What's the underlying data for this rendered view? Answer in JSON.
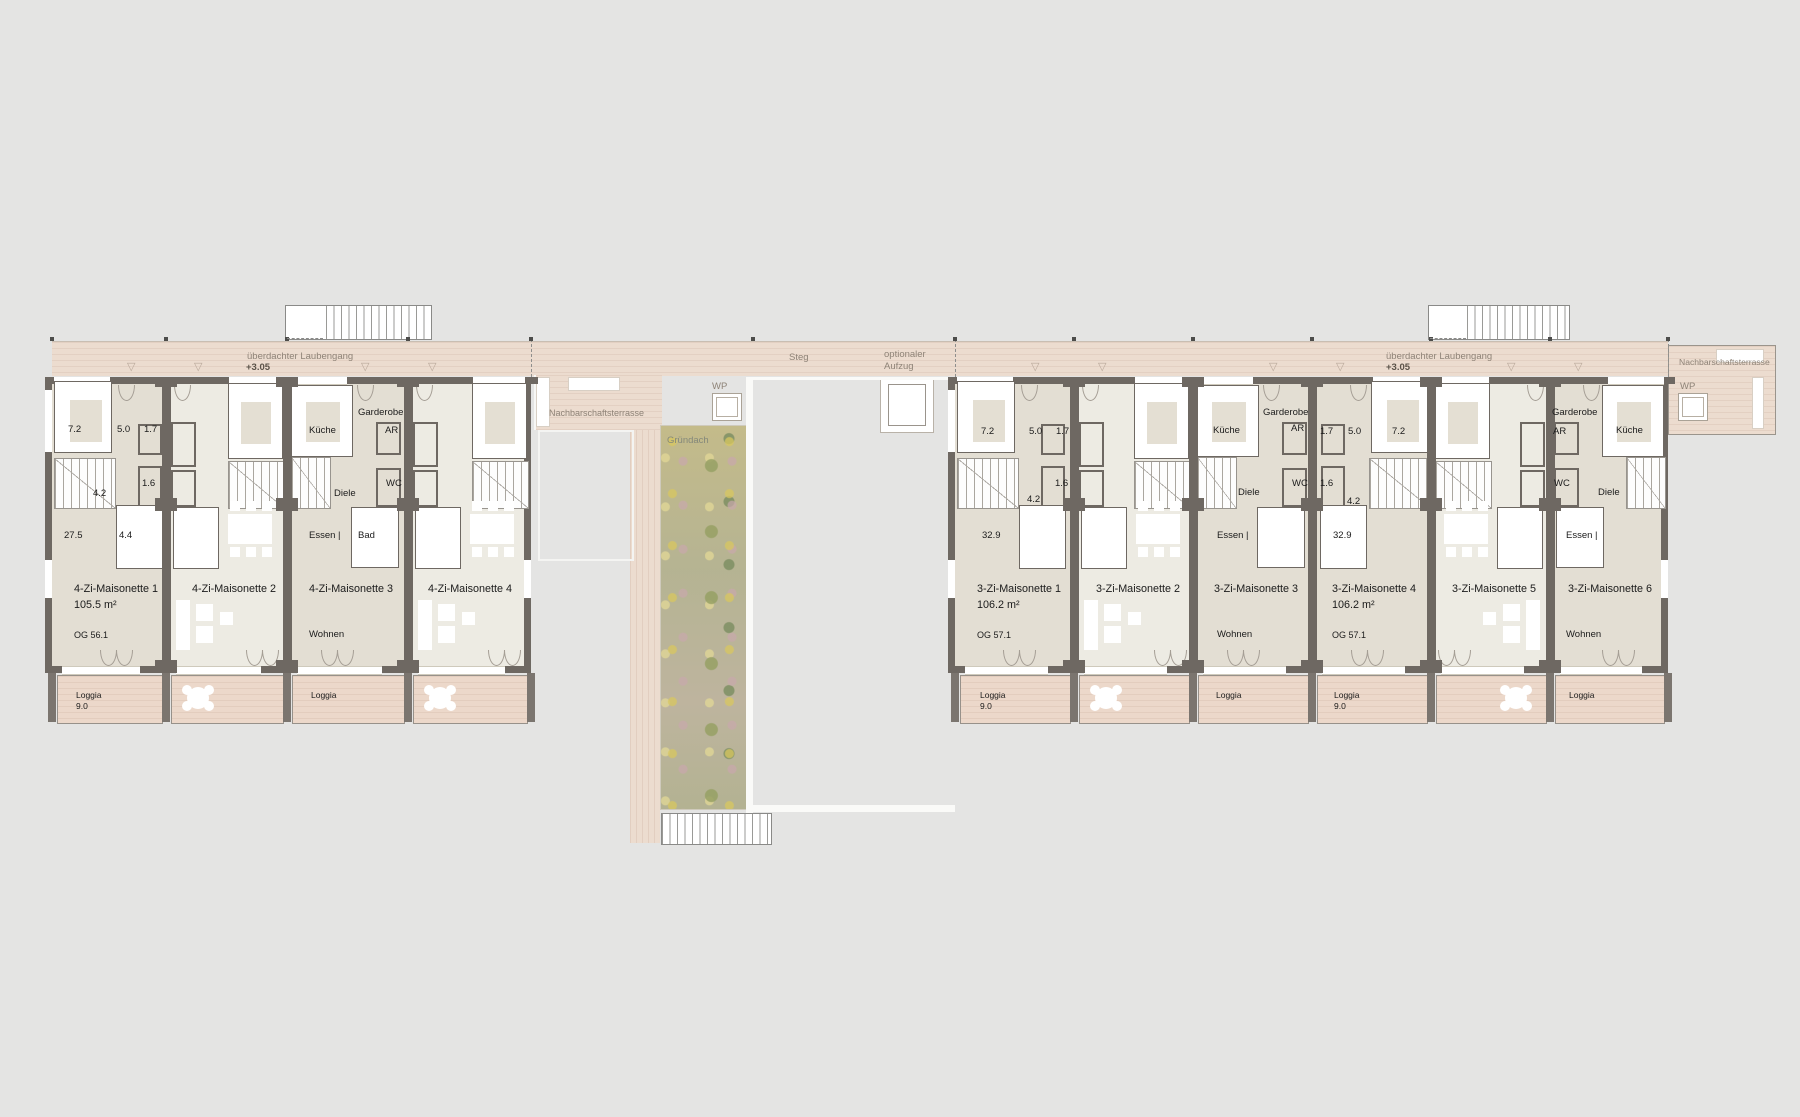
{
  "colors": {
    "background": "#e4e4e3",
    "wood": "#ecdccf",
    "loggia_wood": "#ecd8ca",
    "wall": "#6e6862",
    "room_dark": "#e3ded3",
    "room_light": "#edebe3",
    "inner_beige": "#e4dfd3",
    "muted_text": "#8e8377"
  },
  "laubengang": {
    "label": "überdachter Laubengang",
    "level": "+3.05"
  },
  "middle": {
    "steg": "Steg",
    "aufzug_1": "optionaler",
    "aufzug_2": "Aufzug",
    "terrasse": "Nachbarschaftsterrasse",
    "wp": "WP",
    "gruendach": "Gründach"
  },
  "right_terrace": {
    "terrasse": "Nachbarschaftsterrasse",
    "wp": "WP"
  },
  "blocks": [
    {
      "id": "left",
      "bounds": [
        52,
        166,
        287,
        408,
        531
      ],
      "units": [
        {
          "name": "4-Zi-Maisonette 1",
          "area": "105.5 m²",
          "og": "OG 56.1",
          "type": "end",
          "mirror": false,
          "fill": "dark",
          "name_x": 74,
          "info_x": 74,
          "loggia": {
            "label": "Loggia",
            "value": "9.0",
            "label_x": 76
          },
          "labels": [
            [
              "7.2",
              68,
              424
            ],
            [
              "5.0",
              117,
              424
            ],
            [
              "1.7",
              144,
              424
            ],
            [
              "1.6",
              142,
              478
            ],
            [
              "4.2",
              93,
              488
            ],
            [
              "27.5",
              64,
              530
            ],
            [
              "4.4",
              119,
              530
            ]
          ]
        },
        {
          "name": "4-Zi-Maisonette 2",
          "type": "living",
          "mirror": false,
          "fill": "light",
          "name_x": 192,
          "loggia": {
            "table": "left"
          },
          "labels": []
        },
        {
          "name": "4-Zi-Maisonette 3",
          "type": "kitchen",
          "mirror": false,
          "fill": "dark",
          "name_x": 309,
          "loggia": {
            "label": "Loggia",
            "label_x": 311
          },
          "labels": [
            [
              "Küche",
              309,
              425
            ],
            [
              "Garderobe",
              358,
              407
            ],
            [
              "AR",
              385,
              425
            ],
            [
              "WC",
              386,
              478
            ],
            [
              "Diele",
              334,
              488
            ],
            [
              "Essen |",
              309,
              530
            ],
            [
              "Bad",
              358,
              530
            ],
            [
              "Wohnen",
              309,
              629
            ]
          ]
        },
        {
          "name": "4-Zi-Maisonette 4",
          "type": "living",
          "mirror": false,
          "fill": "light",
          "name_x": 428,
          "loggia": {
            "table": "left"
          },
          "labels": []
        }
      ]
    },
    {
      "id": "right",
      "bounds": [
        955,
        1074,
        1193,
        1312,
        1431,
        1550,
        1668
      ],
      "units": [
        {
          "name": "3-Zi-Maisonette 1",
          "area": "106.2 m²",
          "og": "OG 57.1",
          "type": "end",
          "mirror": false,
          "fill": "dark",
          "name_x": 977,
          "info_x": 977,
          "loggia": {
            "label": "Loggia",
            "value": "9.0",
            "label_x": 980
          },
          "labels": [
            [
              "7.2",
              981,
              426
            ],
            [
              "5.0",
              1029,
              426
            ],
            [
              "1.7",
              1056,
              426
            ],
            [
              "1.6",
              1055,
              478
            ],
            [
              "4.2",
              1027,
              494
            ],
            [
              "32.9",
              982,
              530
            ]
          ]
        },
        {
          "name": "3-Zi-Maisonette 2",
          "type": "living",
          "mirror": false,
          "fill": "light",
          "name_x": 1096,
          "loggia": {
            "table": "left"
          },
          "labels": []
        },
        {
          "name": "3-Zi-Maisonette 3",
          "type": "kitchen",
          "mirror": false,
          "fill": "dark",
          "name_x": 1214,
          "loggia": {
            "label": "Loggia",
            "label_x": 1216
          },
          "labels": [
            [
              "Küche",
              1213,
              425
            ],
            [
              "Garderobe",
              1263,
              407
            ],
            [
              "AR",
              1291,
              423
            ],
            [
              "WC",
              1292,
              478
            ],
            [
              "Diele",
              1238,
              487
            ],
            [
              "Essen |",
              1217,
              530
            ],
            [
              "Wohnen",
              1217,
              629
            ]
          ]
        },
        {
          "name": "3-Zi-Maisonette 4",
          "area": "106.2 m²",
          "og": "OG 57.1",
          "type": "end",
          "mirror": true,
          "fill": "dark",
          "name_x": 1332,
          "info_x": 1332,
          "loggia": {
            "label": "Loggia",
            "value": "9.0",
            "label_x": 1334
          },
          "labels": [
            [
              "1.7",
              1320,
              426
            ],
            [
              "5.0",
              1348,
              426
            ],
            [
              "7.2",
              1392,
              426
            ],
            [
              "1.6",
              1320,
              478
            ],
            [
              "4.2",
              1347,
              496
            ],
            [
              "32.9",
              1333,
              530
            ]
          ]
        },
        {
          "name": "3-Zi-Maisonette 5",
          "type": "living",
          "mirror": true,
          "fill": "light",
          "name_x": 1452,
          "loggia": {
            "table": "right"
          },
          "labels": []
        },
        {
          "name": "3-Zi-Maisonette 6",
          "type": "kitchen",
          "mirror": true,
          "fill": "dark",
          "name_x": 1568,
          "loggia": {
            "label": "Loggia",
            "label_x": 1569
          },
          "labels": [
            [
              "Garderobe",
              1552,
              407
            ],
            [
              "AR",
              1553,
              426
            ],
            [
              "WC",
              1554,
              478
            ],
            [
              "Küche",
              1616,
              425
            ],
            [
              "Diele",
              1598,
              487
            ],
            [
              "Essen |",
              1566,
              530
            ],
            [
              "Wohnen",
              1566,
              629
            ]
          ]
        }
      ]
    }
  ],
  "triangles_x": [
    133,
    200,
    367,
    434,
    1037,
    1104,
    1275,
    1342,
    1513,
    1580
  ],
  "posts_x": [
    52,
    166,
    287,
    408,
    531,
    753,
    955,
    1074,
    1193,
    1312,
    1431,
    1550,
    1668
  ]
}
